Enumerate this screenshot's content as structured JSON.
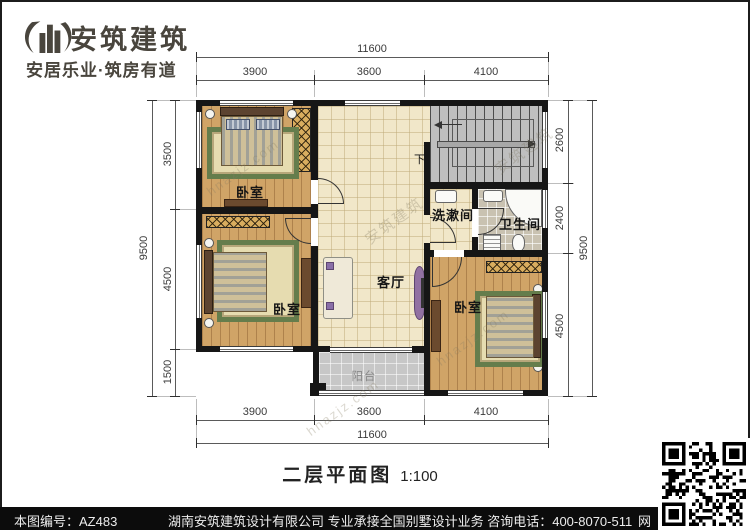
{
  "brand": {
    "name": "安筑建筑",
    "tagline": "安居乐业·筑房有道"
  },
  "title": {
    "text": "二层平面图",
    "scale": "1:100"
  },
  "rooms": {
    "bedroom_nw": "卧室",
    "bedroom_sw": "卧室",
    "bedroom_se": "卧室",
    "living": "客厅",
    "washroom": "洗漱间",
    "bathroom": "卫生间",
    "balcony": "阳台",
    "stairs_down": "下"
  },
  "dims": {
    "top": {
      "total": "11600",
      "segments": [
        "3900",
        "3600",
        "4100"
      ]
    },
    "bottom": {
      "total": "11600",
      "segments": [
        "3900",
        "3600",
        "4100"
      ]
    },
    "left": {
      "total": "9500",
      "segments": [
        "3500",
        "4500",
        "1500"
      ]
    },
    "right": {
      "total": "9500",
      "segments": [
        "2600",
        "2400",
        "4500"
      ]
    }
  },
  "watermark": {
    "site": "hnazjz.com",
    "brand": "安筑建筑"
  },
  "footer": {
    "sheet_no": "本图编号：AZ483",
    "company_line": "湖南安筑建筑设计有限公司  专业承接全国别墅设计业务  咨询电话：400-8070-511",
    "web_char": "网"
  },
  "colors": {
    "wall": "#161616",
    "wood": "#d0a467",
    "tile": "#f1e7c9",
    "accent_purple": "#9271a2",
    "rug_green": "#657d4c",
    "footer_bg": "#0c0c0c"
  }
}
